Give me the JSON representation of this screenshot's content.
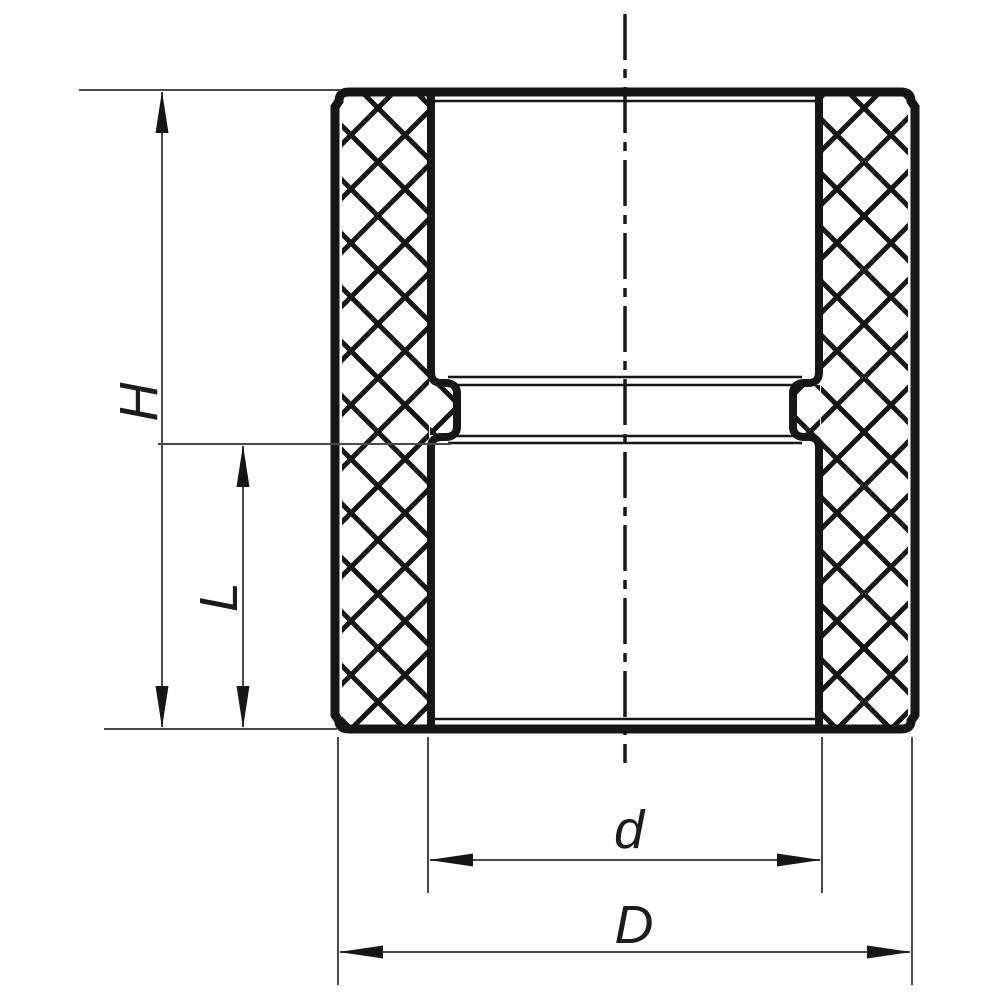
{
  "page": {
    "background": "#ffffff"
  },
  "drawing": {
    "title": "Pipe coupling (socket) cross-section technical drawing",
    "body_line_color": "#161616",
    "dimension_line_color": "#4a4a4a",
    "hatch_style": "diagonal crosshatch (knurled outer walls)"
  },
  "labels": {
    "overall_height": "H",
    "socket_depth": "L",
    "inner_diameter": "d",
    "outer_diameter": "D"
  }
}
